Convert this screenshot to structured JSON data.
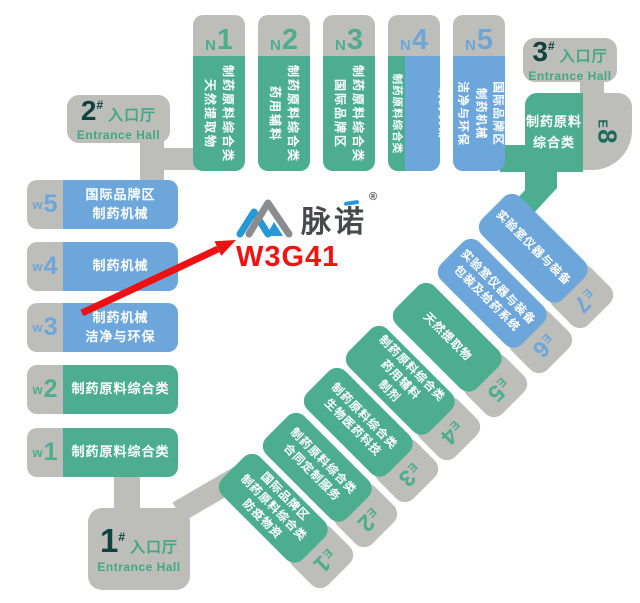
{
  "branding": {
    "logo_text": "脉诺",
    "registered_mark": "®",
    "booth_code": "W3G41"
  },
  "entrances": {
    "e1": {
      "number": "1",
      "hash": "#",
      "hall_cn": "入口厅",
      "hall_en": "Entrance Hall"
    },
    "e2": {
      "number": "2",
      "hash": "#",
      "hall_cn": "入口厅",
      "hall_en": "Entrance Hall"
    },
    "e3": {
      "number": "3",
      "hash": "#",
      "hall_cn": "入口厅",
      "hall_en": "Entrance Hall"
    }
  },
  "north_halls": {
    "n1": {
      "letter": "N",
      "number": "1",
      "lines": [
        "制药原料综合类",
        "天然提取物"
      ]
    },
    "n2": {
      "letter": "N",
      "number": "2",
      "lines": [
        "制药原料综合类",
        "药用辅料"
      ]
    },
    "n3": {
      "letter": "N",
      "number": "3",
      "lines": [
        "制药原料综合类",
        "国际品牌区"
      ]
    },
    "n4": {
      "letter": "N",
      "number": "4",
      "green_line": "制药原料综合类",
      "blue_lines": [
        "包装及给药系统",
        "制药机械"
      ]
    },
    "n5": {
      "letter": "N",
      "number": "5",
      "lines": [
        "国际品牌区",
        "制药机械",
        "洁净与环保"
      ]
    }
  },
  "west_halls": {
    "w5": {
      "letter": "w",
      "number": "5",
      "lines": [
        "国际品牌区",
        "制药机械"
      ]
    },
    "w4": {
      "letter": "w",
      "number": "4",
      "lines": [
        "制药机械"
      ]
    },
    "w3": {
      "letter": "w",
      "number": "3",
      "lines": [
        "制药机械",
        "洁净与环保"
      ]
    },
    "w2": {
      "letter": "w",
      "number": "2",
      "lines": [
        "制药原料综合类"
      ]
    },
    "w1": {
      "letter": "w",
      "number": "1",
      "lines": [
        "制药原料综合类"
      ]
    }
  },
  "east_halls": {
    "e1": {
      "letter": "E",
      "number": "1",
      "lines": [
        "国际品牌区",
        "制药原料综合类",
        "防疫物资"
      ]
    },
    "e2": {
      "letter": "E",
      "number": "2",
      "lines": [
        "制药原料综合类",
        "合同定制服务"
      ]
    },
    "e3": {
      "letter": "E",
      "number": "3",
      "lines": [
        "制药原料综合类",
        "生物医药科技"
      ]
    },
    "e4": {
      "letter": "E",
      "number": "4",
      "lines": [
        "制药原料综合类",
        "药用辅料",
        "制剂"
      ]
    },
    "e5": {
      "letter": "E",
      "number": "5",
      "lines": [
        "天然提取物"
      ]
    },
    "e6": {
      "letter": "E",
      "number": "6",
      "lines": [
        "实验室仪器与装备",
        "包装及给药系统"
      ]
    },
    "e7": {
      "letter": "E",
      "number": "7",
      "lines": [
        "实验室仪器与装备"
      ]
    },
    "e8": {
      "letter": "E",
      "number": "8",
      "lines": [
        "制药原料",
        "综合类"
      ]
    }
  },
  "colors": {
    "hall_green": "#4cae8e",
    "hall_blue": "#6ca6da",
    "connector_gray": "#bdbdba",
    "entrance_number_dark": "#10433e",
    "entrance_text_green": "#41a883",
    "e8_label_teal": "#1c6b5d",
    "arrow_red": "#ee1111",
    "booth_red": "#f11212",
    "logo_blue": "#2598d5",
    "logo_gray": "#8a8c8e"
  }
}
